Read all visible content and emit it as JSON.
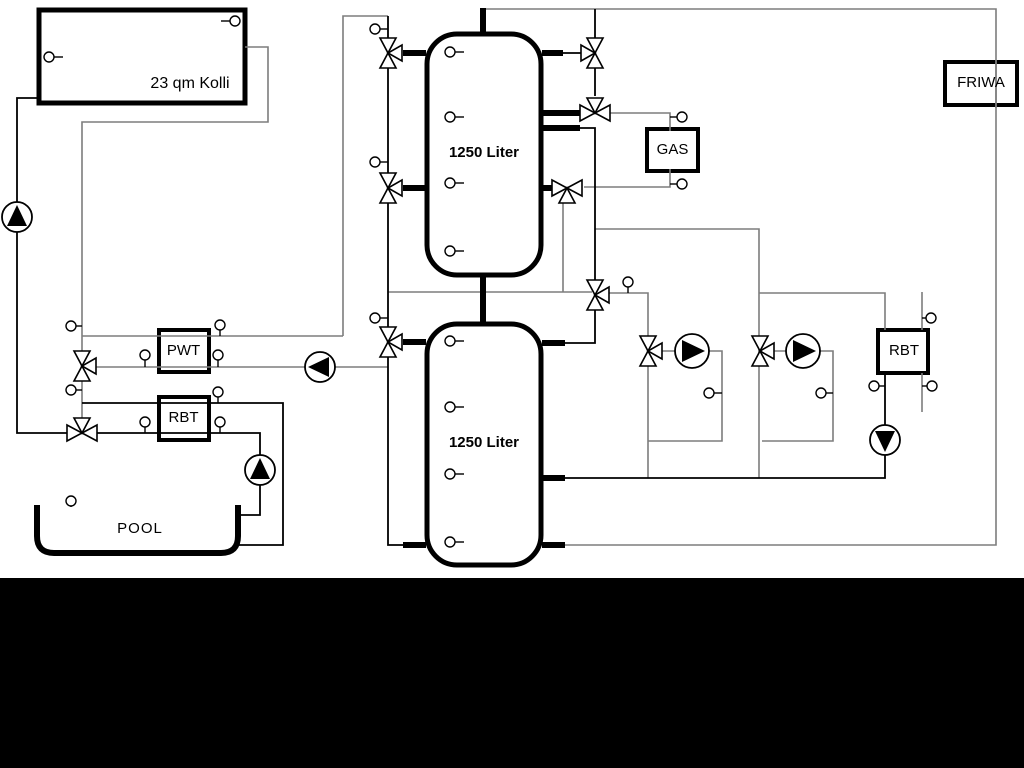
{
  "diagram": {
    "title_none": "",
    "labels": {
      "collector": "23 qm Kolli",
      "tank1": "1250 Liter",
      "tank2": "1250 Liter",
      "pwt": "PWT",
      "rbt_left": "RBT",
      "gas": "GAS",
      "friwa": "FRIWA",
      "rbt_right": "RBT",
      "pool": "POOL"
    },
    "colors": {
      "background": "#ffffff",
      "bottom_band": "#000000",
      "line_dark": "#000000",
      "line_gray": "#7d7d7d",
      "pump_fill": "#000000",
      "box_stroke": "#000000"
    },
    "legend": {
      "pump_icon": "circle with solid triangle showing flow direction",
      "three_way_valve_icon": "double-triangle bowtie with third arrow port",
      "temperature_sensor_icon": "small circle with stem tick"
    },
    "equipment_counts": {
      "storage_tanks": 2,
      "pumps": 6,
      "three_way_valves": 11,
      "temperature_sensors": 30,
      "heat_exchangers": 3,
      "boiler": 1,
      "fresh_water_station": 1,
      "solar_collector": 1,
      "pool": 1
    }
  }
}
